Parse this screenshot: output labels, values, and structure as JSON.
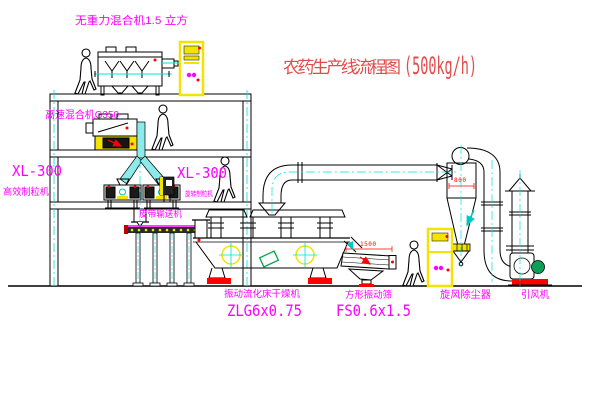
{
  "title": {
    "text": "农药生产线流程图",
    "capacity": "(500kg/h)"
  },
  "equipment": {
    "gravityless_mixer": {
      "label": "无重力混合机1.5 立方"
    },
    "high_speed_mixer": {
      "label": "高速混合机G350"
    },
    "granulator_left": {
      "model": "XL-300",
      "name": "高效制粒机"
    },
    "granulator_right": {
      "model": "XL-300",
      "name": "旋转制粒机"
    },
    "belt_conveyor": {
      "label": "皮带输送机"
    },
    "dryer": {
      "name": "振动流化床干燥机",
      "model": "ZLG6x0.75"
    },
    "sieve": {
      "name": "方形振动筛",
      "model": "FS0.6x1.5",
      "dim_width": "1500"
    },
    "cyclone": {
      "name": "旋风除尘器",
      "dim_width": "800"
    },
    "fan": {
      "name": "引风机"
    }
  },
  "colors": {
    "label_magenta": "#ff00ff",
    "title_red": "#e14b4b",
    "dimension_red": "#ff0000",
    "line_black": "#000000",
    "accent_cyan": "#00e0e0",
    "accent_yellow": "#f2e400",
    "accent_green": "#00a550"
  }
}
